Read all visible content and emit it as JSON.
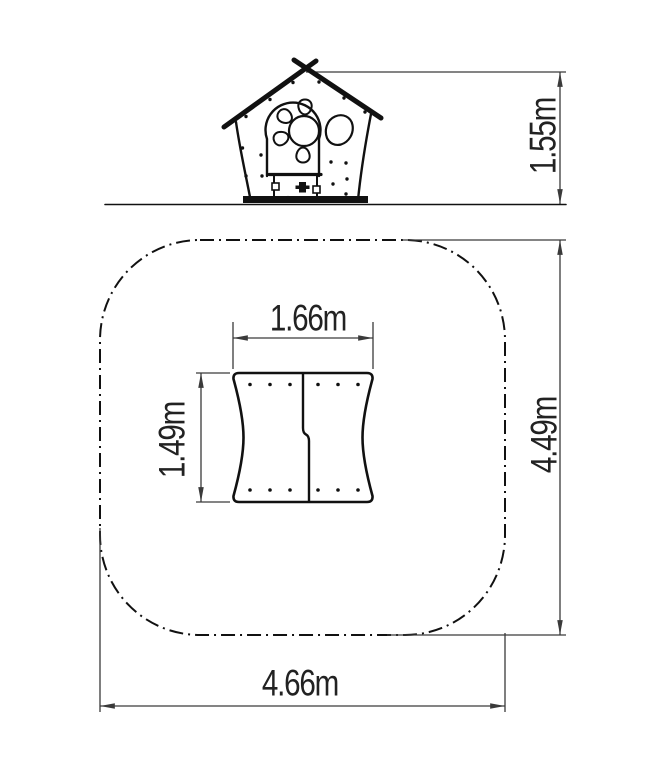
{
  "colors": {
    "background": "#ffffff",
    "line": "#111111",
    "dimension": "#3a3a3a",
    "text": "#222222"
  },
  "dimensions": {
    "elevation_height": "1.55m",
    "footprint_width": "1.66m",
    "footprint_depth": "1.49m",
    "safety_zone_width": "4.66m",
    "safety_zone_depth": "4.49m"
  }
}
